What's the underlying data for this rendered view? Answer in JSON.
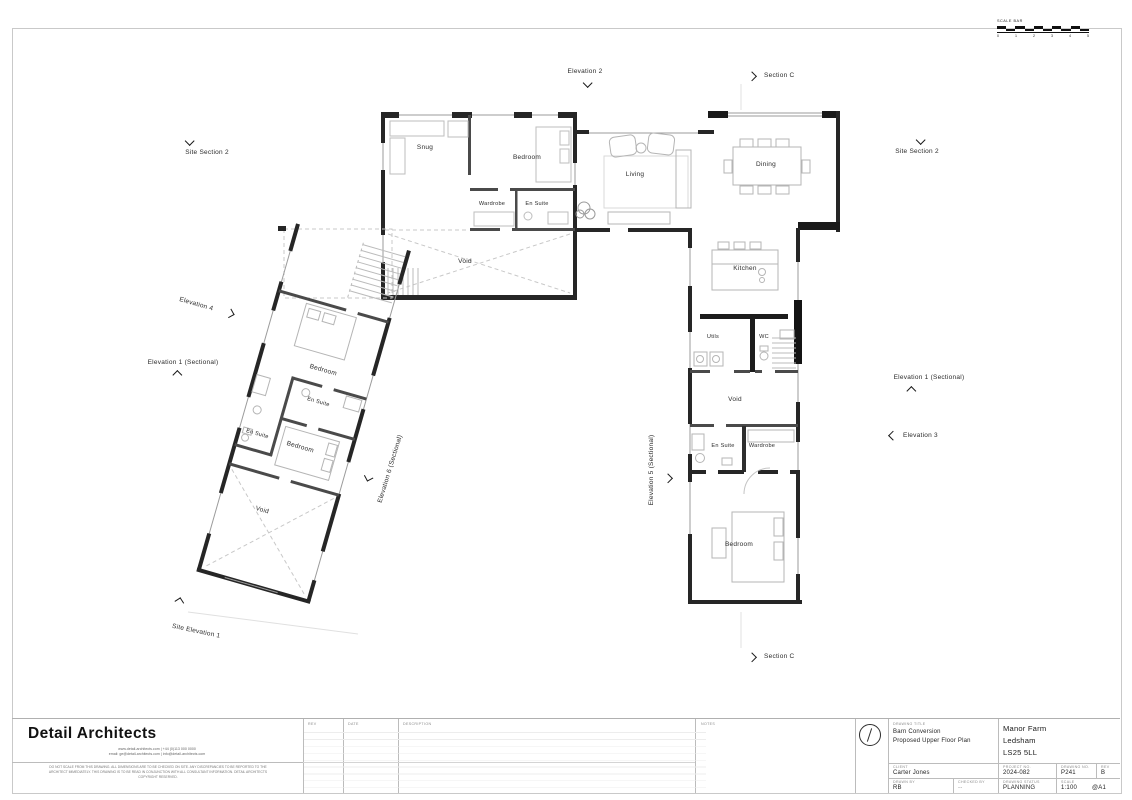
{
  "scale_bar": {
    "label": "SCALE BAR",
    "ticks": [
      "0",
      "1",
      "2",
      "3",
      "4",
      "5"
    ]
  },
  "markers": {
    "elevation2": "Elevation 2",
    "sectionC_top": "Section C",
    "siteSection2_left": "Site Section 2",
    "siteSection2_right": "Site Section 2",
    "elevation4": "Elevation 4",
    "elevation1_left": "Elevation 1 (Sectional)",
    "elevation6": "Elevation 6 (Sectional)",
    "elevation5": "Elevation 5 (Sectional)",
    "elevation1_right": "Elevation 1 (Sectional)",
    "elevation3": "Elevation 3",
    "siteElevation1": "Site Elevation 1",
    "sectionC_bottom": "Section C"
  },
  "rooms": {
    "snug": "Snug",
    "bedroom_main": "Bedroom",
    "wardrobe_main": "Wardrobe",
    "ensuite_main": "En Suite",
    "void_main": "Void",
    "living": "Living",
    "dining": "Dining",
    "kitchen": "Kitchen",
    "utils": "Utils",
    "wc": "WC",
    "void_right": "Void",
    "ensuite_right": "En Suite",
    "wardrobe_right": "Wardrobe",
    "bedroom_right": "Bedroom",
    "bedroom_w1": "Bedroom",
    "ensuite_w1": "En Suite",
    "ensuite_w2": "En Suite",
    "bedroom_w2": "Bedroom",
    "void_w": "Void"
  },
  "titleblock": {
    "firm": "Detail Architects",
    "contact1": "www.detail-architects.com  |  +44 (0)113 000 0000",
    "contact2": "email: ge@detail-architects.com  |  info@detail-architects.com",
    "disclaimer": "DO NOT SCALE FROM THIS DRAWING. ALL DIMENSIONS ARE TO BE CHECKED ON SITE. ANY DISCREPANCIES TO BE REPORTED TO THE ARCHITECT IMMEDIATELY. THIS DRAWING IS TO BE READ IN CONJUNCTION WITH ALL CONSULTANT INFORMATION. DETAIL ARCHITECTS COPYRIGHT RESERVED.",
    "rev_header": "REV",
    "date_header": "DATE",
    "description_header": "DESCRIPTION",
    "notes_header": "NOTES",
    "drawing_title_label": "DRAWING TITLE",
    "drawing_title1": "Barn Conversion",
    "drawing_title2": "Proposed Upper Floor Plan",
    "client_label": "CLIENT",
    "client": "Carter Jones",
    "address1": "Manor Farm",
    "address2": "Ledsham",
    "address3": "LS25 5LL",
    "project_no_label": "PROJECT NO.",
    "project_no": "2024-082",
    "drawing_no_label": "DRAWING NO.",
    "drawing_no": "P241",
    "rev_label": "REV",
    "rev": "B",
    "drawn_by_label": "DRAWN BY",
    "drawn_by": "RB",
    "checked_by_label": "CHECKED BY",
    "checked_by": "--",
    "status_label": "DRAWING STATUS",
    "status": "PLANNING",
    "scale_label": "SCALE",
    "scale": "1:100",
    "paper": "@A1"
  }
}
